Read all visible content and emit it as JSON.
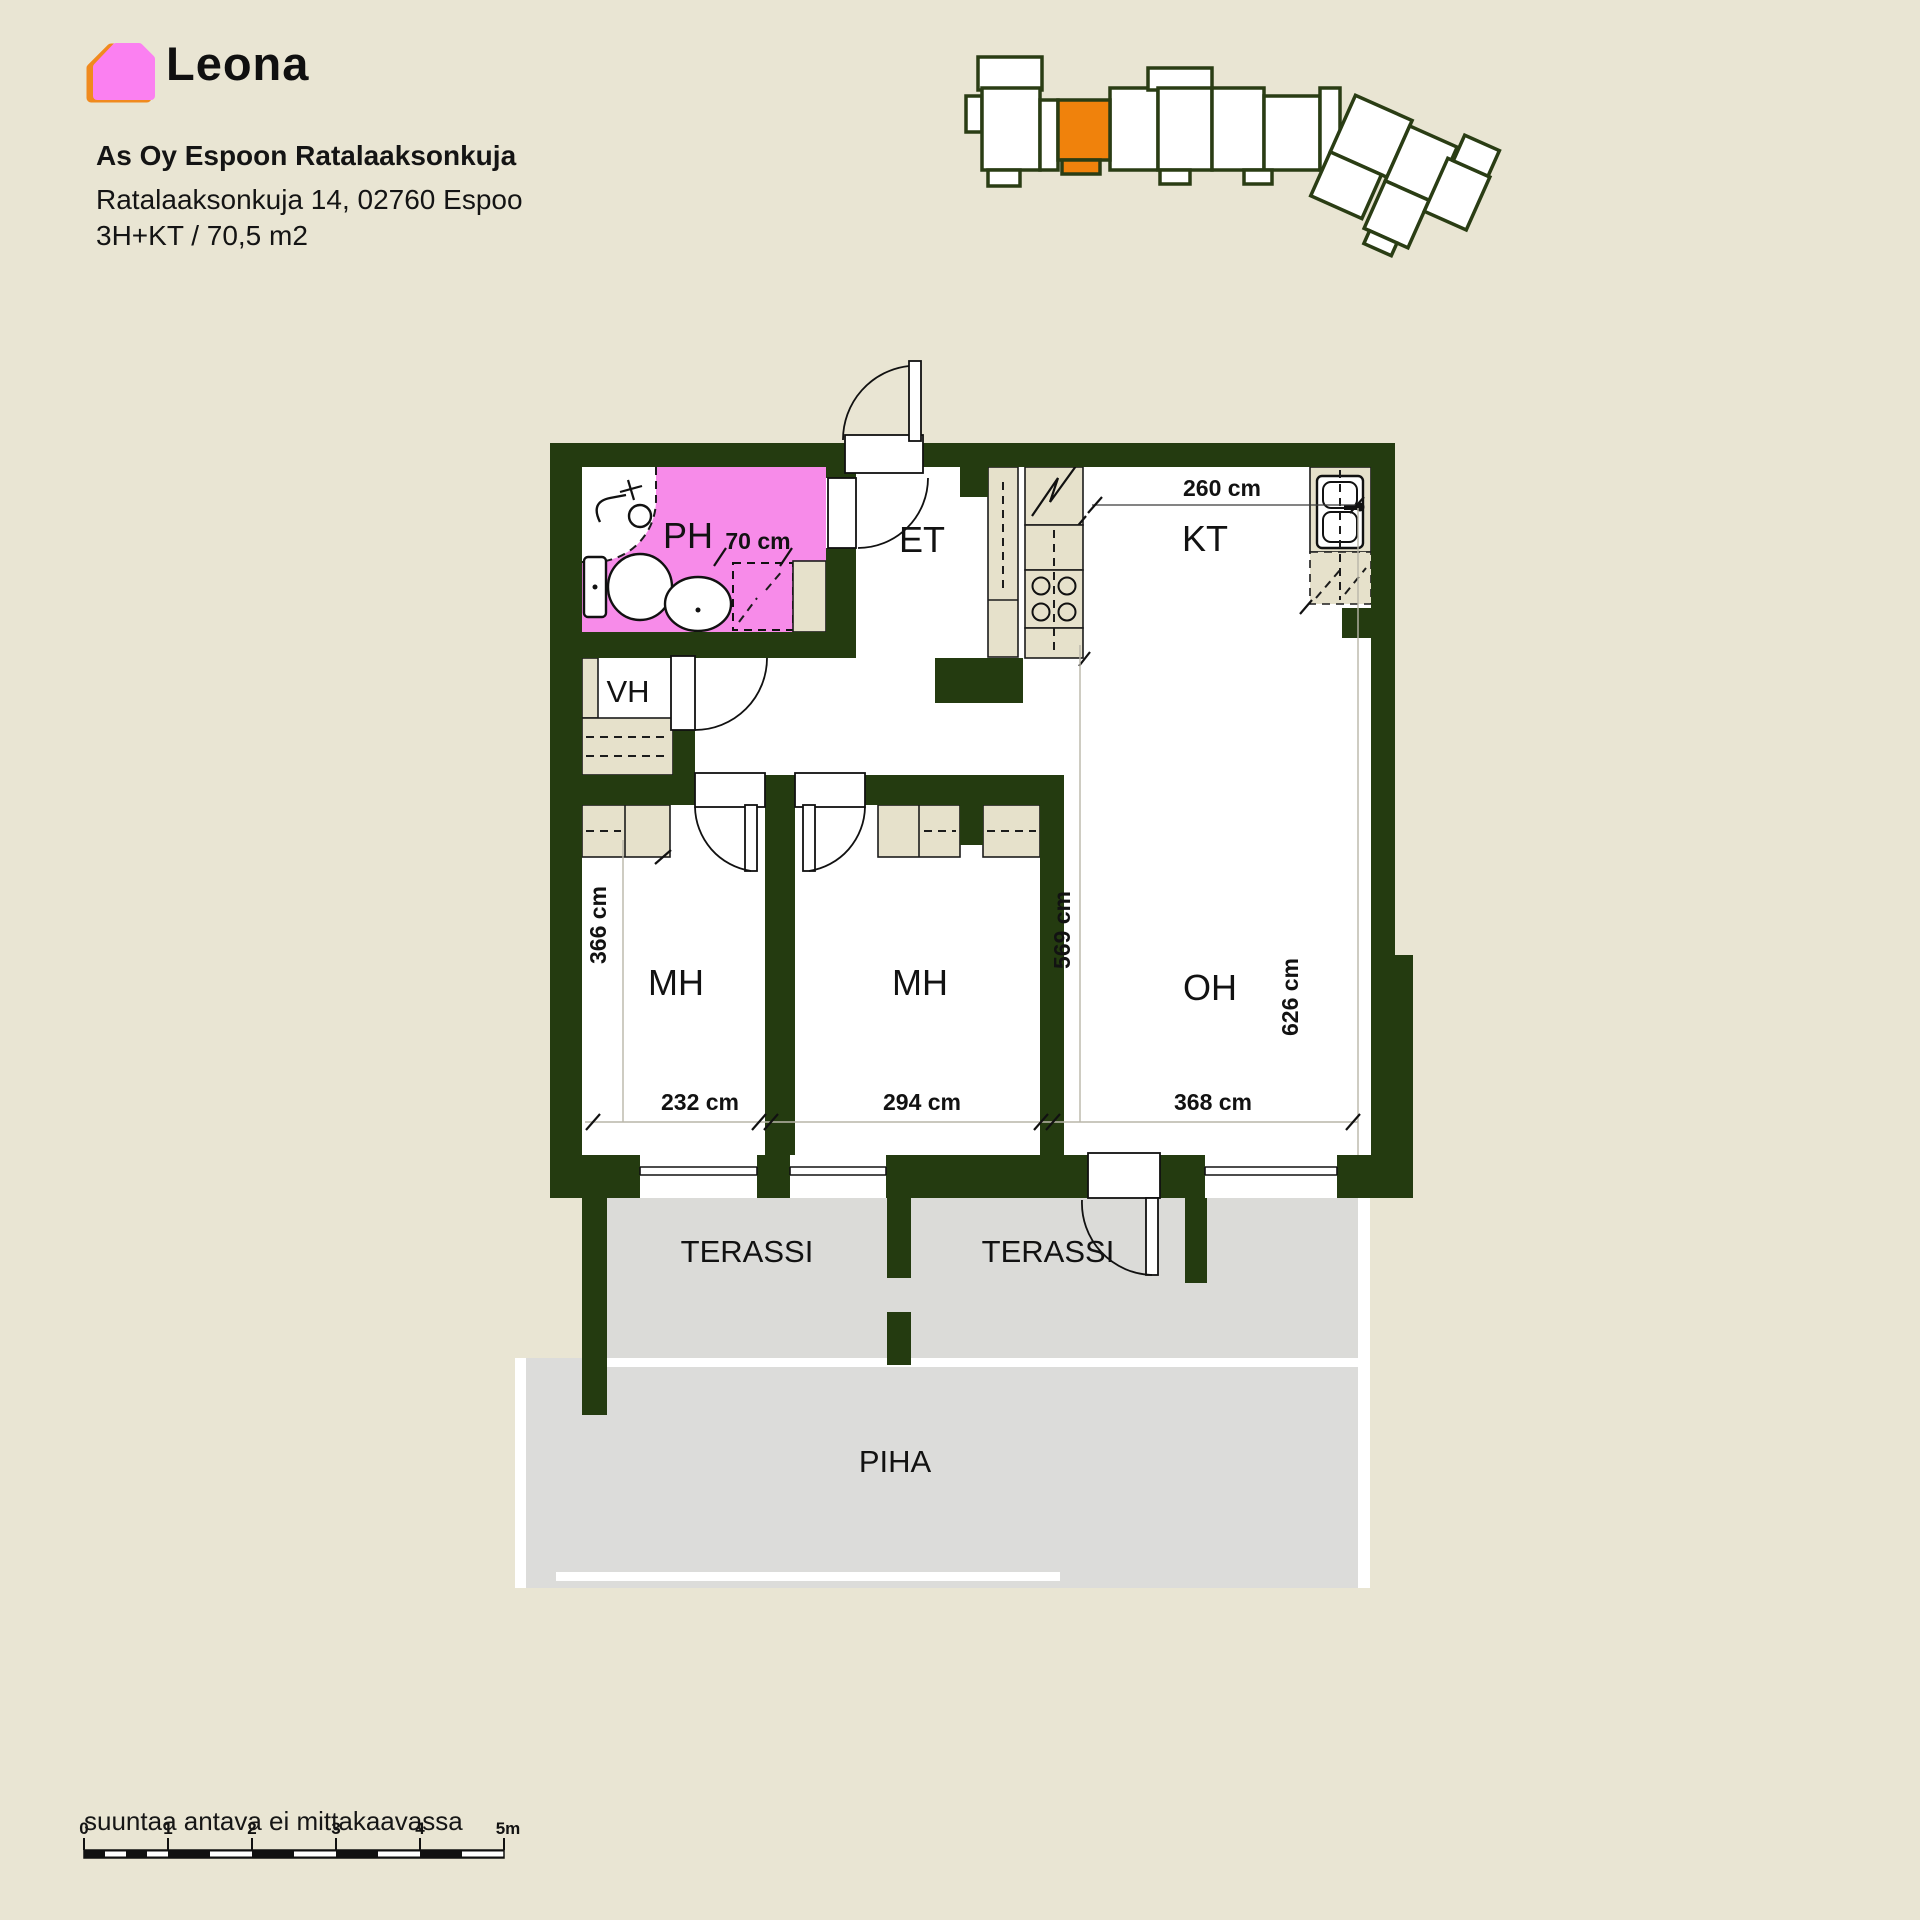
{
  "header": {
    "logo_text": "Leona",
    "title": "As Oy Espoon Ratalaaksonkuja",
    "address": "Ratalaaksonkuja 14, 02760 Espoo",
    "apartment_type": "3H+KT / 70,5 m2"
  },
  "site_plan": {
    "highlight_color": "#F0820C",
    "outline_color": "#2A3D14"
  },
  "floorplan": {
    "colors": {
      "wall": "#243B10",
      "bathroom": "#F78BE9",
      "furniture": "#E6E1CB",
      "terrace": "#DBDBD8",
      "background": "#E9E5D3"
    },
    "rooms": {
      "bathroom": "PH",
      "entry": "ET",
      "kitchen": "KT",
      "closet": "VH",
      "bedroom1": "MH",
      "bedroom2": "MH",
      "living": "OH",
      "terrace1": "TERASSI",
      "terrace2": "TERASSI",
      "yard": "PIHA"
    },
    "dimensions": {
      "kitchen_width": "260 cm",
      "shower_width": "70 cm",
      "bedroom1_depth": "366 cm",
      "bedroom1_width": "232 cm",
      "bedroom2_width": "294 cm",
      "bedroom2_depth": "569 cm",
      "living_depth": "626 cm",
      "living_width": "368 cm"
    }
  },
  "footer": {
    "note": "suuntaa antava ei mittakaavassa",
    "scale_ticks": [
      "0",
      "1",
      "2",
      "3",
      "4",
      "5m"
    ]
  }
}
